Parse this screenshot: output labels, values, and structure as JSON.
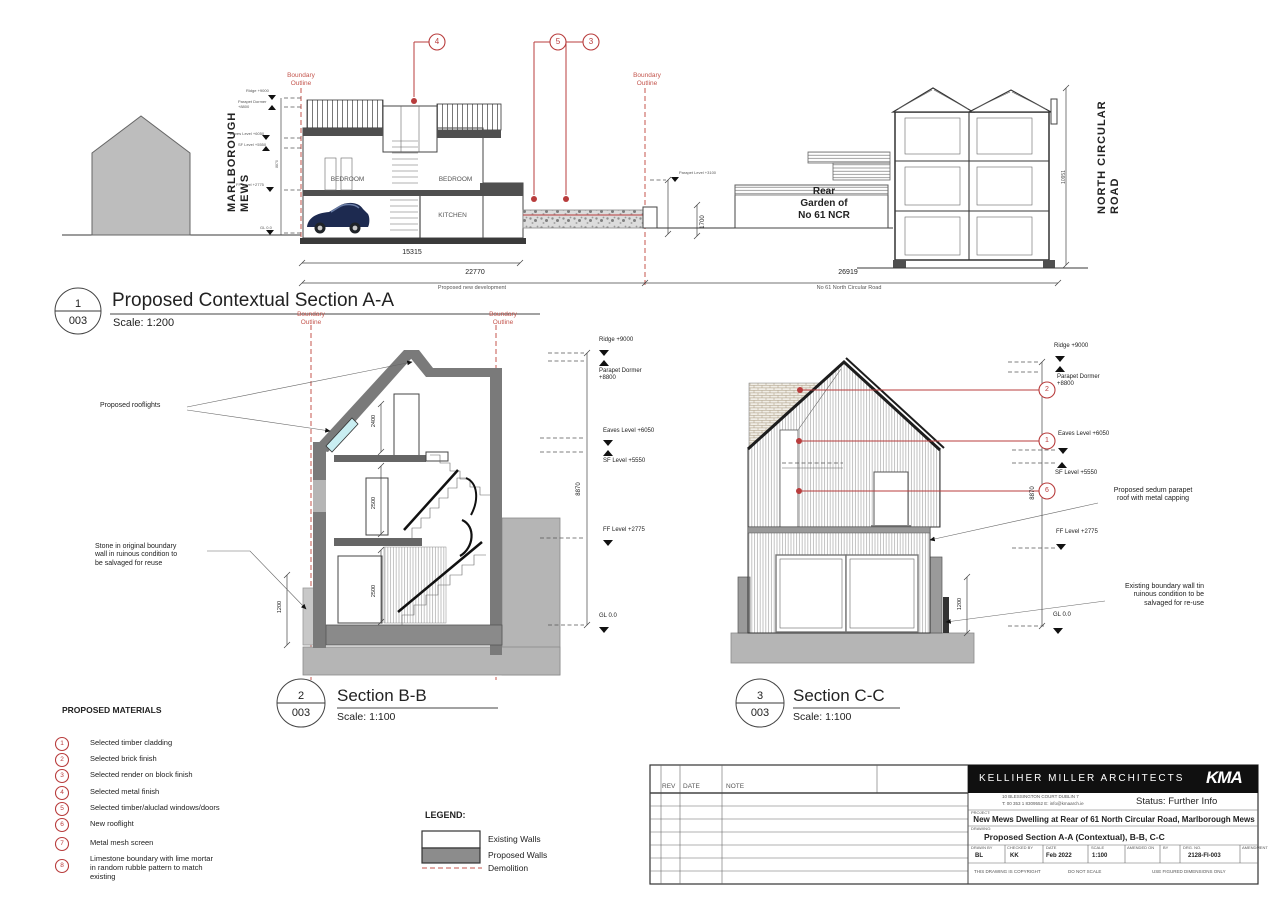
{
  "colors": {
    "red": "#b83c3c",
    "red2": "#c4564e",
    "wall": "#7a7a7a",
    "ground": "#b5b5b5",
    "cyan": "#c9eef2"
  },
  "boundary": "Boundary\nOutline",
  "levels": {
    "ridge": "Ridge +9000",
    "parapet_dormer": "Parapet Dormer\n+8800",
    "eaves": "Eaves Level +6050",
    "sf": "SF Level +5550",
    "ff": "FF Level +2775",
    "gl": "GL 0.0",
    "overall": "8870"
  },
  "section_a": {
    "num": "1",
    "sheet": "003",
    "title": "Proposed Contextual Section A-A",
    "scale": "Scale: 1:200",
    "street_left": "MARLBOROUGH MEWS",
    "street_right": "NORTH CIRCULAR ROAD",
    "rooms": {
      "bedroom1": "BEDROOM",
      "bedroom2": "BEDROOM",
      "kitchen": "KITCHEN"
    },
    "garden": "Rear\nGarden of\nNo 61 NCR",
    "callouts": [
      "4",
      "5",
      "3"
    ],
    "parapet_small": "Parapet Level +3100",
    "dims": {
      "w1": "15315",
      "w2": "22770",
      "w3": "26919",
      "h_wall": "1700",
      "h_no61": "10951"
    },
    "caption_left": "Proposed new development",
    "caption_right": "No 61 North Circular Road"
  },
  "section_b": {
    "num": "2",
    "sheet": "003",
    "title": "Section B-B",
    "scale": "Scale: 1:100",
    "note_rooflights": "Proposed rooflights",
    "note_stone": "Stone in original boundary\nwall in ruinous condition to\nbe salvaged for reuse",
    "dims": {
      "d1": "2400",
      "d2": "2500",
      "d3": "2500",
      "d4": "1200"
    }
  },
  "section_c": {
    "num": "3",
    "sheet": "003",
    "title": "Section C-C",
    "scale": "Scale: 1:100",
    "callouts": [
      "2",
      "1",
      "6"
    ],
    "note_sedum": "Proposed sedum parapet\nroof with metal capping",
    "note_wall": "Existing boundary wall tin\nruinous condition to be\nsalvaged for re-use",
    "dim_wall": "1200"
  },
  "materials": {
    "header": "PROPOSED MATERIALS",
    "items": [
      {
        "num": "1",
        "label": "Selected timber cladding"
      },
      {
        "num": "2",
        "label": "Selected brick finish"
      },
      {
        "num": "3",
        "label": "Selected render on block finish"
      },
      {
        "num": "4",
        "label": "Selected metal finish"
      },
      {
        "num": "5",
        "label": "Selected timber/aluclad windows/doors"
      },
      {
        "num": "6",
        "label": "New rooflight"
      },
      {
        "num": "7",
        "label": "Metal mesh screen"
      },
      {
        "num": "8",
        "label": "Limestone boundary with lime mortar\nin random rubble pattern to match\nexisting"
      }
    ]
  },
  "legend": {
    "header": "LEGEND:",
    "existing": "Existing Walls",
    "proposed": "Proposed Walls",
    "demolition": "Demolition"
  },
  "titleblock": {
    "rev": "REV",
    "date": "DATE",
    "note": "NOTE",
    "firm": "KELLIHER MILLER ARCHITECTS",
    "logo": "KMA",
    "address1": "10  BLESSINGTON COURT        DUBLIN 7",
    "address2": "T: 00 353 1 8309552        E: info@kmaarch.ie",
    "status": "Status: Further Info",
    "project_label": "PROJECT:",
    "project": "New Mews Dwelling at Rear of 61 North Circular Road, Marlborough Mews",
    "drawing_label": "DRAWING:",
    "drawing": "Proposed Section A-A (Contextual), B-B, C-C",
    "meta": [
      {
        "h": "DRAWN BY",
        "v": "BL"
      },
      {
        "h": "CHECKED BY",
        "v": "KK"
      },
      {
        "h": "DATE",
        "v": "Feb 2022"
      },
      {
        "h": "SCALE",
        "v": "1:100"
      },
      {
        "h": "AMENDED ON",
        "v": ""
      },
      {
        "h": "BY",
        "v": ""
      },
      {
        "h": "DRG. NO.",
        "v": "2128-FI-003"
      },
      {
        "h": "AMENDMENT",
        "v": ""
      }
    ],
    "footer": [
      "THIS DRAWING IS COPYRIGHT",
      "DO NOT SCALE",
      "USE FIGURED DIMENSIONS ONLY"
    ]
  }
}
